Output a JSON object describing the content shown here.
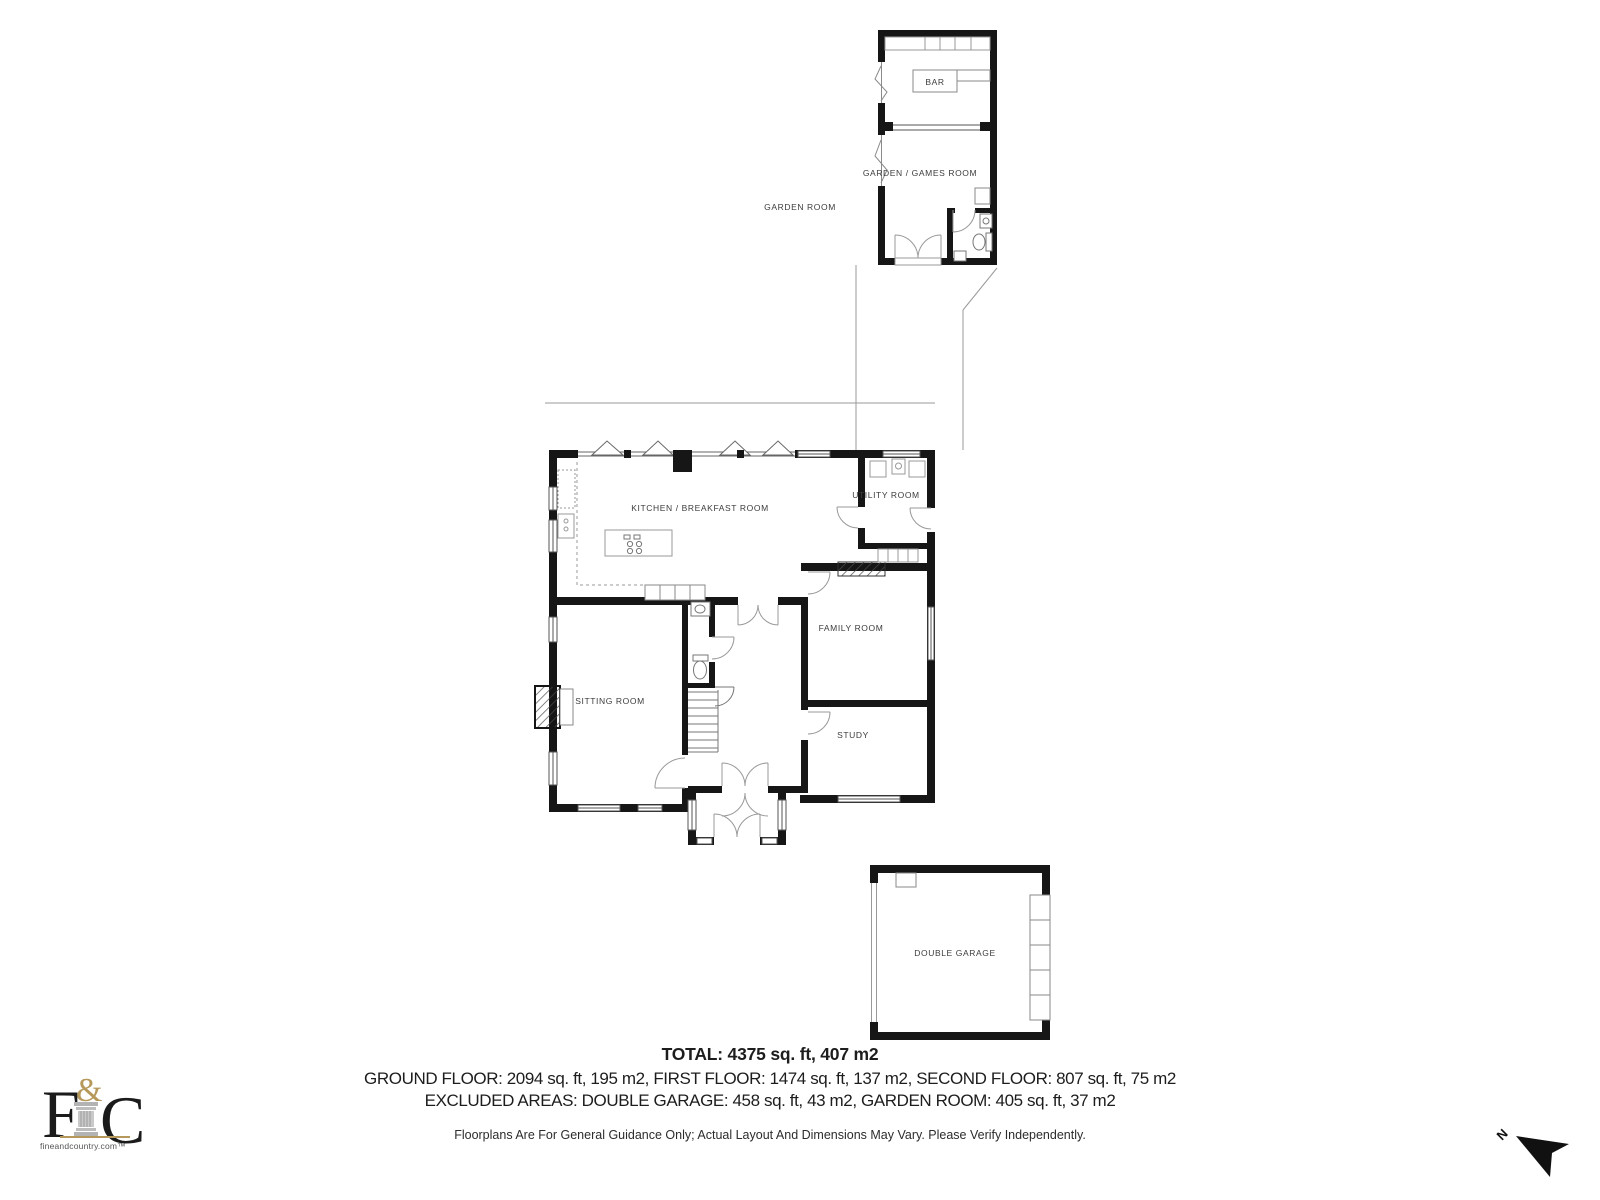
{
  "rooms": {
    "bar": "BAR",
    "garden_games_room": "GARDEN / GAMES ROOM",
    "garden_room": "GARDEN ROOM",
    "kitchen": "KITCHEN / BREAKFAST ROOM",
    "utility": "UTILITY ROOM",
    "family": "FAMILY ROOM",
    "sitting": "SITTING ROOM",
    "study": "STUDY",
    "garage": "DOUBLE GARAGE"
  },
  "summary": {
    "total": "TOTAL: 4375 sq. ft, 407 m2",
    "floors": "GROUND FLOOR: 2094 sq. ft, 195 m2, FIRST FLOOR: 1474 sq. ft, 137 m2, SECOND FLOOR: 807 sq. ft, 75 m2",
    "excluded": "EXCLUDED AREAS: DOUBLE GARAGE: 458 sq. ft, 43 m2, GARDEN ROOM: 405 sq. ft, 37 m2",
    "disclaimer": "Floorplans Are For General Guidance Only; Actual Layout And Dimensions May Vary. Please Verify Independently."
  },
  "branding": {
    "letter_f": "F",
    "ampersand": "&",
    "letter_c": "C",
    "website": "fineandcountry.com™",
    "gold": "#b5985a"
  },
  "compass": {
    "north": "N"
  },
  "colors": {
    "wall": "#161616",
    "line": "#8a8a8a",
    "text": "#3c3c3c"
  }
}
